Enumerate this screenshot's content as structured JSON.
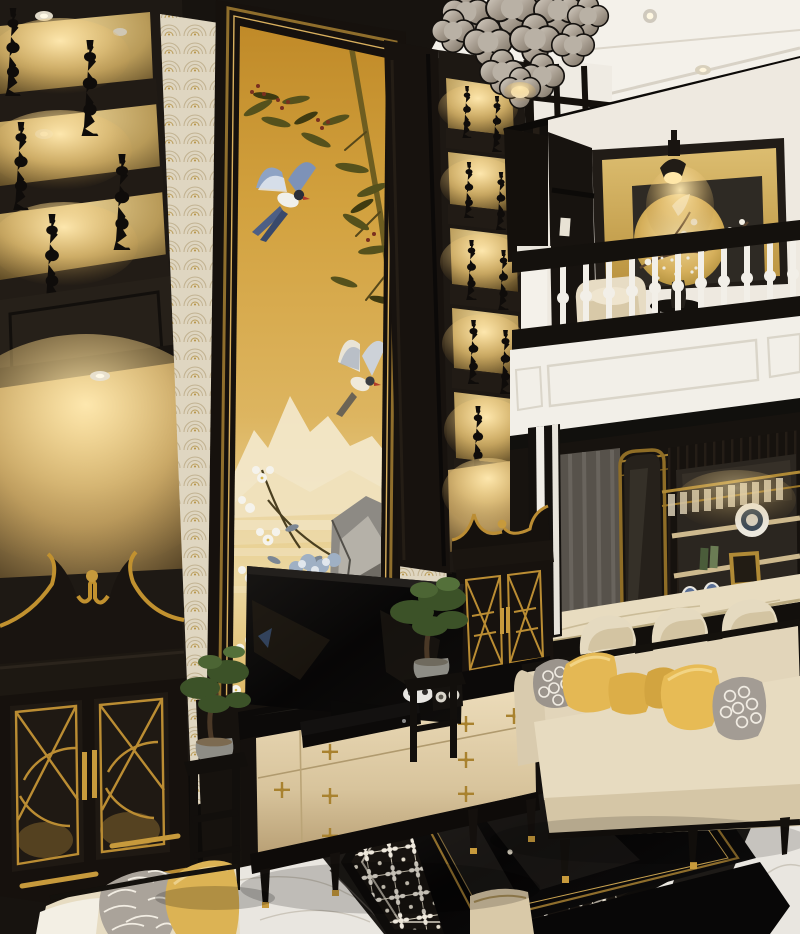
{
  "image_type": "photoreal-interior-render",
  "scene": {
    "description": "Two-story Indochine style living room: black lacquer shelving with warm-lit gold niches, tall golden mural of birds and bamboo, mezzanine with white balustrade and golden moon artwork, mirrored bar with marble counter and cream stools, cream sofa with yellow and quatrefoil pillows, glossy black coffee table on black-and-white patterned rug over white marble floor, tiered quatrefoil chandelier.",
    "elements": [
      "chandelier",
      "ceiling",
      "fret-beam",
      "left-shelving",
      "gold-niche",
      "fan-wallpaper",
      "bird-bamboo-mural",
      "right-shelving",
      "mezzanine-art-wall",
      "wall-sconce",
      "balustrade",
      "white-fascia",
      "bar-back-shelving",
      "bar-counter",
      "bar-stools",
      "curtain",
      "mirror-door",
      "sofa",
      "pillows",
      "coffee-table",
      "patterned-rug",
      "marble-floor",
      "tv",
      "media-console",
      "media-devices",
      "bonsai-left",
      "bonsai-right",
      "plant-stands",
      "pagoda-cabinet-left",
      "pagoda-cabinet-right",
      "armchair-foreground",
      "mezzanine-armchair",
      "side-table-gypsophila"
    ]
  },
  "palette": {
    "millwork_black": "#1e1914",
    "deep_black": "#0d0b09",
    "mural_gold": "#d2a13e",
    "niche_gold": "#c0a469",
    "trim_gold": "#b5882f",
    "bright_gold": "#d9ae55",
    "wall_cream": "#ece4d1",
    "ceiling_white": "#f4f1ea",
    "fascia_white": "#f2efe8",
    "marble_white": "#e9e6e0",
    "sofa_cream": "#e2d5ba",
    "pillow_yellow": "#e4b854",
    "pillow_gray": "#9b948c",
    "rug_white": "#efe9dd",
    "rug_black": "#141110",
    "bonsai_green": "#42552c",
    "bird_blue": "#7d92b8",
    "shade_gray": "#b3a99d",
    "counter_marble": "#e8dcc0"
  }
}
